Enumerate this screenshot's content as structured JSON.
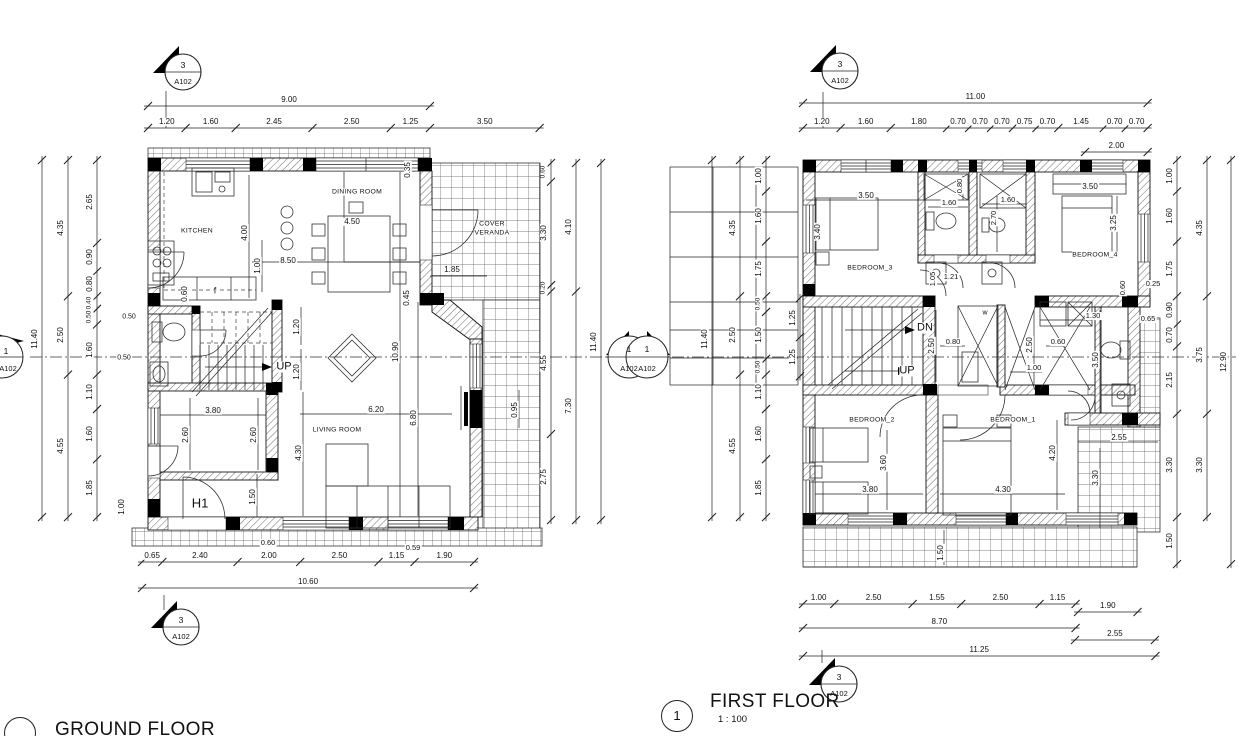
{
  "titles": {
    "ground": "GROUND FLOOR",
    "first": "FIRST FLOOR",
    "first_scale": "1 : 100",
    "first_number": "1"
  },
  "markers": {
    "section_number": "3",
    "sheet": "A102",
    "elevation_number": "1"
  },
  "ground_floor": {
    "chains": {
      "top_total": [
        "9.00"
      ],
      "top_segments": [
        "1.20",
        "1.60",
        "2.45",
        "2.50",
        "1.25",
        "3.50"
      ],
      "left_outer": [
        "11.40"
      ],
      "left_mid": [
        "4.35",
        "2.50",
        "4.55"
      ],
      "left_inner": [
        "2.65",
        "0.90",
        "0.80",
        "0.40",
        "0.50",
        "1.60",
        "1.10",
        "1.60",
        "1.85"
      ],
      "bottom_segments": [
        "0.65",
        "2.40",
        "2.00",
        "2.50",
        "1.15",
        "1.90"
      ],
      "bottom_total": [
        "10.60"
      ],
      "right_inner": [
        "0.60",
        "3.30",
        "0.20",
        "4.55",
        "2.75"
      ],
      "right_mid": [
        "4.10",
        "7.30"
      ],
      "right_outer": [
        "11.40"
      ]
    },
    "dims": [
      "4.00",
      "1.00",
      "8.50",
      "4.50",
      "0.35",
      "0.60",
      "1.85",
      "1.20",
      "1.20",
      "10.90",
      "0.45",
      "3.80",
      "2.60",
      "2.60",
      "6.20",
      "6.80",
      "4.30",
      "1.50",
      "0.95",
      "0.50",
      "0.50",
      "1.00",
      "0.60",
      "0.59"
    ],
    "rooms": [
      "KITCHEN",
      "DINING ROOM",
      "COVER",
      "VERANDA",
      "LIVING ROOM"
    ],
    "notes": [
      "UP",
      "H1",
      "f"
    ]
  },
  "first_floor": {
    "chains": {
      "top_total": [
        "11.00"
      ],
      "top_segments": [
        "1.20",
        "1.60",
        "1.80",
        "0.70",
        "0.70",
        "0.70",
        "0.75",
        "0.70",
        "1.45",
        "0.70",
        "0.70"
      ],
      "top_sub": [
        "2.00"
      ],
      "left_outer": [
        "11.40"
      ],
      "left_mid": [
        "4.35",
        "2.50",
        "4.55"
      ],
      "left_inner": [
        "1.00",
        "1.60",
        "1.75",
        "0.50",
        "1.50",
        "0.50",
        "1.10",
        "1.60",
        "1.85"
      ],
      "left_stair": [
        "1.25",
        "1.25"
      ],
      "right_a": [
        "1.00",
        "1.60",
        "1.75",
        "0.90",
        "0.70",
        "2.15",
        "3.30",
        "1.50"
      ],
      "right_b": [
        "4.35",
        "3.75",
        "3.30"
      ],
      "right_outer": [
        "12.90"
      ],
      "bottom_segments": [
        "1.00",
        "2.50",
        "1.55",
        "2.50",
        "1.15"
      ],
      "bottom_sub": [
        "1.90"
      ],
      "bottom_mid": [
        "8.70"
      ],
      "bottom_right": [
        "2.55"
      ],
      "bottom_total": [
        "11.25"
      ]
    },
    "dims": [
      "3.50",
      "3.40",
      "1.60",
      "0.80",
      "1.60",
      "2.70",
      "1.05",
      "1.21",
      "3.50",
      "3.25",
      "0.60",
      "0.25",
      "1.30",
      "0.65",
      "2.50",
      "0.80",
      "2.50",
      "1.00",
      "0.60",
      "3.50",
      "3.60",
      "3.80",
      "4.30",
      "4.20",
      "2.55",
      "3.30",
      "1.50"
    ],
    "rooms": [
      "BEDROOM_3",
      "BEDROOM_4",
      "BEDROOM_2",
      "BEDROOM_1"
    ],
    "notes": [
      "DN",
      "UP",
      "w"
    ]
  }
}
